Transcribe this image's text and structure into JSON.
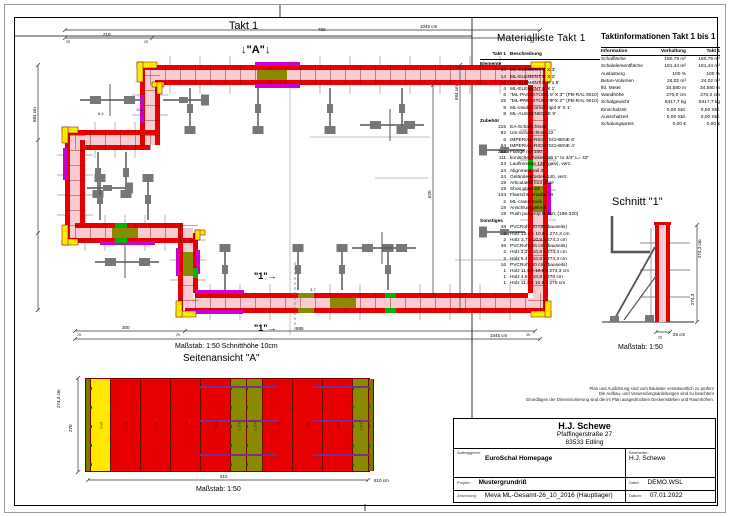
{
  "page": {
    "plan_title": "Takt 1",
    "materialliste_title": "Materialliste  Takt 1",
    "taktinfo_title": "Taktinformationen  Takt 1 bis 1",
    "schnitt_title": "Schnitt \"1\"",
    "seitenansicht_title": "Seitenansicht \"A\"",
    "plan_scale_note": "Maßstab: 1:50   Schnitthöhe 10cm",
    "schnitt_scale": "Maßstab: 1:50",
    "seitenansicht_scale": "Maßstab: 1:50"
  },
  "plan": {
    "marker_a": "↓\"A\"↓",
    "marker_1": "\"1\"→",
    "dims": {
      "top_a": "210",
      "top_b": "760",
      "top_total": "1045 cm",
      "left_total": "684 cm",
      "right_a": "620",
      "right_total": "684 cm",
      "bottom_a": "300",
      "bottom_b": "885",
      "bottom_total": "1045 cm",
      "tick_25": "25",
      "tick_35": "35"
    },
    "annotations": {
      "a1": "6,4",
      "a2": "11,6",
      "a3": "3,7"
    }
  },
  "materialliste": {
    "col_qty": "Takt 1",
    "col_desc": "Beschreibung",
    "groups": [
      {
        "name": "Elemente",
        "items": [
          {
            "qty": "60",
            "desc": "ML-ELEMENT 9' X 3'"
          },
          {
            "qty": "14",
            "desc": "ML-ELEMENT 9' X 2'"
          },
          {
            "qty": "18",
            "desc": "ML-ELEMENT 9' X 1.5'"
          },
          {
            "qty": "4",
            "desc": "ML-ELEMENT 9' X 1'"
          },
          {
            "qty": "6",
            "desc": "\"ML-PASSSTÜCK  9' X 3'\"  (PB-RAL 9010)"
          },
          {
            "qty": "15",
            "desc": "\"ML-PASSSTÜCK  9' X 2'\"  (PB-RAL 9010)"
          },
          {
            "qty": "8",
            "desc": "ML-inside corner rigid 9' X 1'"
          },
          {
            "qty": "8",
            "desc": "ML-AUSSENECKE  9'"
          }
        ]
      },
      {
        "name": "Zubehör",
        "items": [
          {
            "qty": "315",
            "desc": "EA-Schalschloss"
          },
          {
            "qty": "92",
            "desc": "Uni-Schalschloss 22"
          },
          {
            "qty": "6",
            "desc": "IMPERIAL-RICHTSCHIENE 6'"
          },
          {
            "qty": "64",
            "desc": "IMPERIAL-RICHTSCHIENE 4'"
          },
          {
            "qty": "222",
            "desc": "Flange nut 100"
          },
          {
            "qty": "111",
            "desc": "konischer Ankerstab 1\" to 3/4\" L= 42\""
          },
          {
            "qty": "24",
            "desc": "Laufkonsole 126 (galv), verz."
          },
          {
            "qty": "24",
            "desc": "Alignment rail 3'"
          },
          {
            "qty": "24",
            "desc": "Geländerpfosten 140, verz."
          },
          {
            "qty": "19",
            "desc": "Articulated foot plate"
          },
          {
            "qty": "19",
            "desc": "Shoe plate 23"
          },
          {
            "qty": "133",
            "desc": "Flanschschraube 18"
          },
          {
            "qty": "2",
            "desc": "ML-crane hook"
          },
          {
            "qty": "19",
            "desc": "Anschlussgelenk"
          },
          {
            "qty": "19",
            "desc": "Push pull prop R 250, (196-320)"
          }
        ]
      },
      {
        "name": "Sonstiges",
        "items": [
          {
            "qty": "48",
            "desc": "PVCRohr 20 cm (bauseits)"
          },
          {
            "qty": "2",
            "desc": "Holz 13,4 x 10,8 x 274,3 cm"
          },
          {
            "qty": "2",
            "desc": "Holz 3,7 x 10,8 x 274,3 cm"
          },
          {
            "qty": "48",
            "desc": "PVCRohr 26 cm (bauseits)"
          },
          {
            "qty": "2",
            "desc": "Holz 1,2 x 10,8 x 274,3 cm"
          },
          {
            "qty": "2",
            "desc": "Holz 6,4 x 10,8 x 274,3 cm"
          },
          {
            "qty": "16",
            "desc": "PVCRohr 20 cm (bauseits)"
          },
          {
            "qty": "1",
            "desc": "Holz 11,6 x 10,8 x 274,3 cm"
          },
          {
            "qty": "1",
            "desc": "Holz 4,8 x 10,8 x 278 cm"
          },
          {
            "qty": "1",
            "desc": "Holz 11,6 x 10,8 x 270 cm"
          }
        ]
      }
    ]
  },
  "taktinfo": {
    "columns": [
      "Information",
      "Vorhaltung",
      "Takt 1"
    ],
    "rows": [
      [
        "Schalfläche",
        "180,79 m²",
        "180,79 m²"
      ],
      [
        "Schalelementfläche",
        "181,44 m²",
        "181,44 m²"
      ],
      [
        "Auslastung",
        "100 %",
        "100 %"
      ],
      [
        "Beton-Volumen",
        "24,02 m³",
        "24,02 m³"
      ],
      [
        "lfd. Meter",
        "34,580 m",
        "34,580 m"
      ],
      [
        "Wandhöhe",
        "270,0 cm",
        "270,0 cm"
      ],
      [
        "Schalgewicht",
        "8417,7 kg",
        "8417,7 kg"
      ],
      [
        "Einschalzeit",
        "0,00 Std.",
        "0,00 Std."
      ],
      [
        "Ausschalzeit",
        "0,00 Std.",
        "0,00 Std."
      ],
      [
        "Schalungspreis",
        "0,00 €",
        "0,00 €"
      ]
    ]
  },
  "schnitt": {
    "dim_h1": "274,3 cm",
    "dim_h2": "274,3",
    "dim_w": "25 cm",
    "tick": "25"
  },
  "seitenansicht": {
    "dim_h1": "274,3 cm",
    "dim_h2": "270",
    "dim_w": "810",
    "dim_total": "810 cm",
    "panels": [
      {
        "label": "AE 9'",
        "type": "ae"
      },
      {
        "label": "2'x9'",
        "type": "y2"
      },
      {
        "label": "3'x9'",
        "type": "r3"
      },
      {
        "label": "3'x9'",
        "type": "r3"
      },
      {
        "label": "3'x9'",
        "type": "r3"
      },
      {
        "label": "3'x9'",
        "type": "r3"
      },
      {
        "label": "1.5'x9'",
        "type": "o15"
      },
      {
        "label": "1.5'x9'",
        "type": "o15"
      },
      {
        "label": "3'x9'",
        "type": "r3"
      },
      {
        "label": "3'x9'",
        "type": "r3"
      },
      {
        "label": "3'x9'",
        "type": "r3"
      },
      {
        "label": "1.5'x9'",
        "type": "o15"
      },
      {
        "label": "AE 9'",
        "type": "ae"
      }
    ]
  },
  "titleblock": {
    "company": "H.J. Schewe",
    "street": "Pfaffingerstraße 27",
    "city": "83533 Edling",
    "label_auftraggeber": "Auftraggeber:",
    "auftraggeber": "EuroSchal Homepage",
    "label_bearbeiter": "Bearbeiter:",
    "bearbeiter": "H.J. Schewe",
    "label_projekt": "Projekt:",
    "projekt": "Mustergrundriß",
    "label_datei": "Datei:",
    "datei": "DEMO.WSL",
    "label_zeichnung": "Zeichnung:",
    "zeichnung": "Meva ML-Gesamt-26_10_2016 (Hauptlager)",
    "label_datum": "Datum:",
    "datum": "07.01.2022"
  },
  "disclaimer": {
    "lines": [
      "Plan und Ausführung sind vom Bauleiter verantwortlich zu prüfen!",
      "Die Aufbau- und Verwendungsanleitungen sind zu beachten!",
      "Grundlagen der Dimensionierung sind die im Plan ausgedrückten Deckenstärken und Raumhöhen."
    ]
  },
  "colors": {
    "formwork_red": "#e60000",
    "wall_pink": "#f7cdd1",
    "corner_yellow": "#ffe800",
    "passstueck_magenta": "#cc00cc",
    "filler_olive": "#8a8a00",
    "inside_corner_green": "#00b400",
    "brace_gray": "#666666",
    "rail_purple": "#7b2d8b"
  }
}
